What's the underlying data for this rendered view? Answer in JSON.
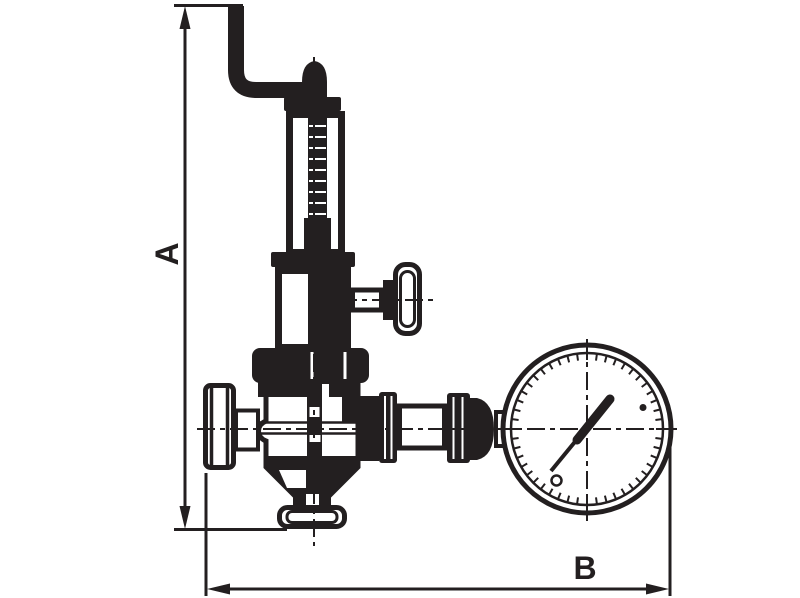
{
  "dimensions": {
    "a_label": "A",
    "b_label": "B"
  },
  "colors": {
    "ink": "#231f20",
    "background": "#ffffff"
  }
}
